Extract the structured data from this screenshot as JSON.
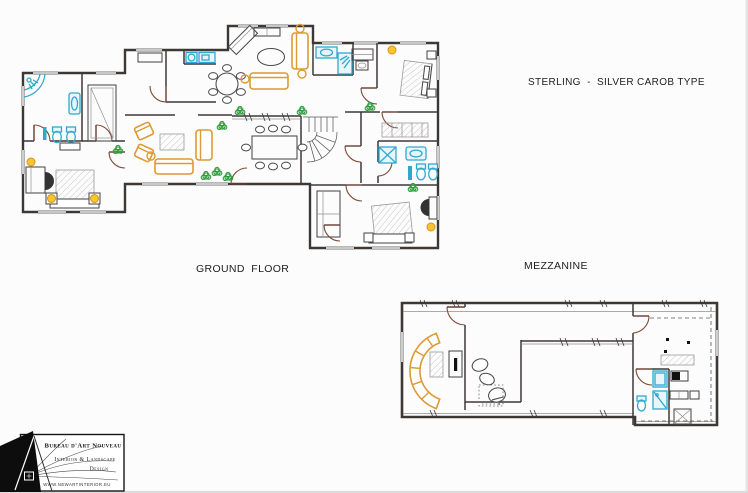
{
  "canvas": {
    "width": 748,
    "height": 493,
    "background": "#fcfcfc"
  },
  "header": {
    "title": "STERLING  -  SILVER CAROB TYPE"
  },
  "floors": [
    {
      "id": "ground-floor",
      "label": "GROUND  FLOOR"
    },
    {
      "id": "mezzanine",
      "label": "MEZZANINE"
    }
  ],
  "logo": {
    "company": "Bureau d'Art Nouveau",
    "tagline_line1": "Interior & Landscape",
    "tagline_line2": "Design",
    "website": "WWW.NEWARTINTERIOR.EU"
  },
  "palette": {
    "walls": "#3c3836",
    "doors": "#7d4a38",
    "furniture_outline": "#4a4a4a",
    "wood_furniture": "#dd9a33",
    "plumbing_fixtures": "#2fa8cf",
    "plants": "#2f9c3c",
    "lamps": "#f6c62f",
    "hatching": "#9a9a9a",
    "paper": "#fcfcfc"
  }
}
